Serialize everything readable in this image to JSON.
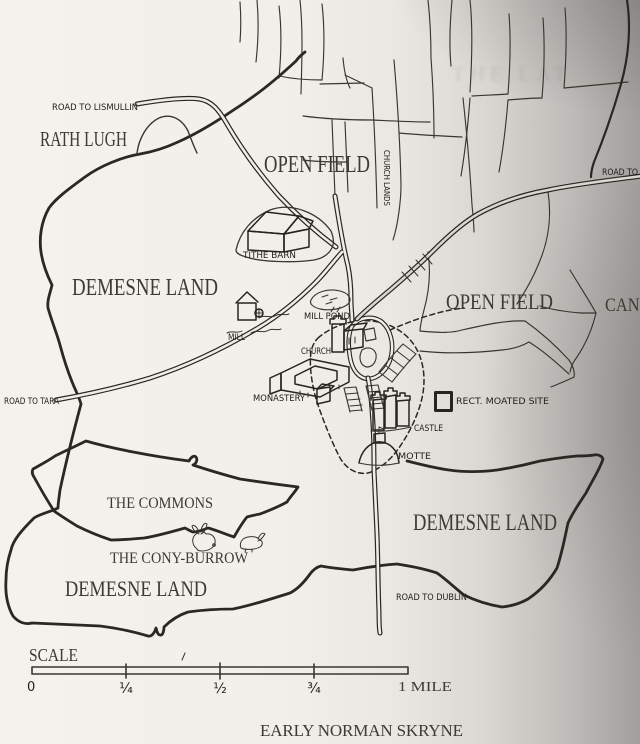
{
  "page": {
    "caption": "EARLY NORMAN SKRYNE",
    "bleed_text": "THE LAT"
  },
  "map": {
    "regions": {
      "rath_lugh": "RATH LUGH",
      "open_field_north": "OPEN FIELD",
      "open_field_east": "OPEN FIELD",
      "demesne_west": "DEMESNE LAND",
      "demesne_southwest": "DEMESNE LAND",
      "demesne_southeast": "DEMESNE LAND",
      "the_commons": "THE COMMONS",
      "the_cony_burrow": "THE CONY-BURROW",
      "church_lands": "CHURCH LANDS",
      "cani": "CANI"
    },
    "roads": {
      "lismullin": "ROAD TO LISMULLIN",
      "east": "ROAD TO",
      "tara": "ROAD TO TARA",
      "dublin": "ROAD TO DUBLIN"
    },
    "features": {
      "tithe_barn": "TITHE BARN",
      "mill": "MILL",
      "mill_pond": "MILL POND",
      "church": "CHURCH",
      "monastery": "MONASTERY",
      "castle": "CASTLE",
      "motte": "MOTTE",
      "moated_site": "RECT. MOATED SITE"
    },
    "scale": {
      "title": "SCALE",
      "zero": "0",
      "quarter": "¼",
      "half": "½",
      "three_quarter": "¾",
      "mile": "1 MILE"
    }
  },
  "colors": {
    "ink": "#28261f",
    "paper": "#f0eee9"
  }
}
